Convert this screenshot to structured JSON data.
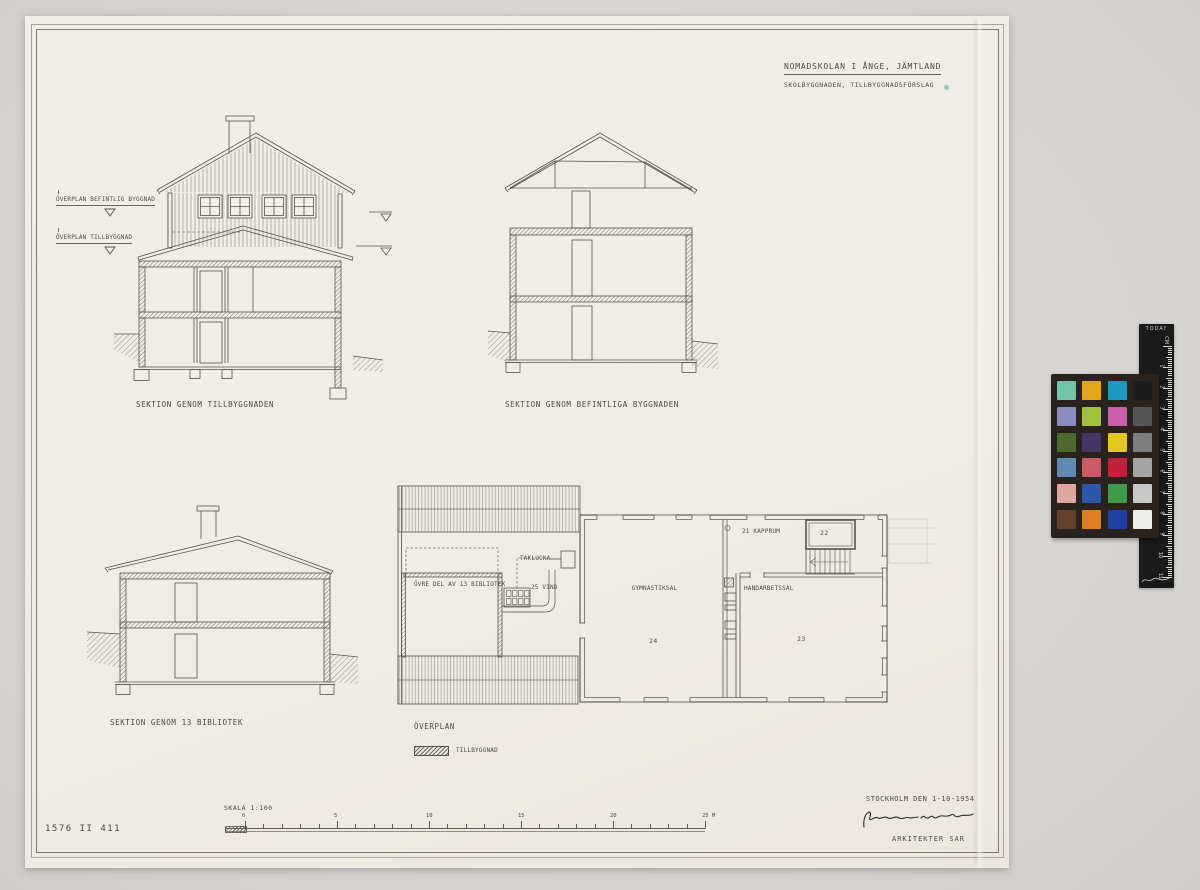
{
  "header": {
    "title": "NOMADSKOLAN I ÅNGE, JÄMTLAND",
    "subtitle": "SKOLBYGGNADEN, TILLBYGGNADSFÖRSLAG"
  },
  "annotations": {
    "level1": "ÖVERPLAN BEFINTLIG BYGGNAD",
    "level2": "ÖVERPLAN TILLBYGGNAD"
  },
  "captions": {
    "section_tillbyggnaden": "SEKTION GENOM TILLBYGGNADEN",
    "section_befintliga": "SEKTION GENOM BEFINTLIGA BYGGNADEN",
    "section_bibliotek": "SEKTION GENOM 13 BIBLIOTEK",
    "plan": "ÖVERPLAN"
  },
  "plan_labels": {
    "library": "ÖVRE DEL AV 13 BIBLIOTEK",
    "vind": "25 VIND",
    "taklucka": "TAKLUCKA",
    "kapprum": "21 KAPPRUM",
    "room22": "22",
    "gym": "GYMNASTIKSAL",
    "gym_no": "24",
    "handarbete": "HANDARBETSSAL",
    "handarbete_no": "23"
  },
  "legend": {
    "swatch_label": "TILLBYGGNAD"
  },
  "scale_bar": {
    "label": "SKALA 1:100",
    "major_labels": [
      "0",
      "5",
      "10",
      "15",
      "20",
      "25 M"
    ]
  },
  "footer": {
    "drawing_no": "1576 II 411",
    "place_date": "STOCKHOLM DEN 1-10-1954",
    "architects": "ARKITEKTER SAR"
  },
  "color_checker": {
    "frame_color": "#2a231d",
    "patch_rows": [
      [
        "#72c5ab",
        "#e4a41d",
        "#1f98c4",
        "#1c1c1c"
      ],
      [
        "#8a8bc0",
        "#a2c23b",
        "#c75fa9",
        "#565656"
      ],
      [
        "#4c682c",
        "#463569",
        "#e5c722",
        "#7e7e7e"
      ],
      [
        "#5f8ab3",
        "#cd5a64",
        "#c32039",
        "#a5a5a5"
      ],
      [
        "#e0a79e",
        "#2e56a8",
        "#3f9a49",
        "#c7c7c6"
      ],
      [
        "#63422b",
        "#e07e22",
        "#1f41a3",
        "#eeeeea"
      ]
    ]
  },
  "ruler": {
    "brand": "TODAY",
    "unit": "CM",
    "numbers": [
      "1",
      "2",
      "3",
      "4",
      "5",
      "6",
      "7",
      "8",
      "9",
      "10",
      "11"
    ]
  }
}
